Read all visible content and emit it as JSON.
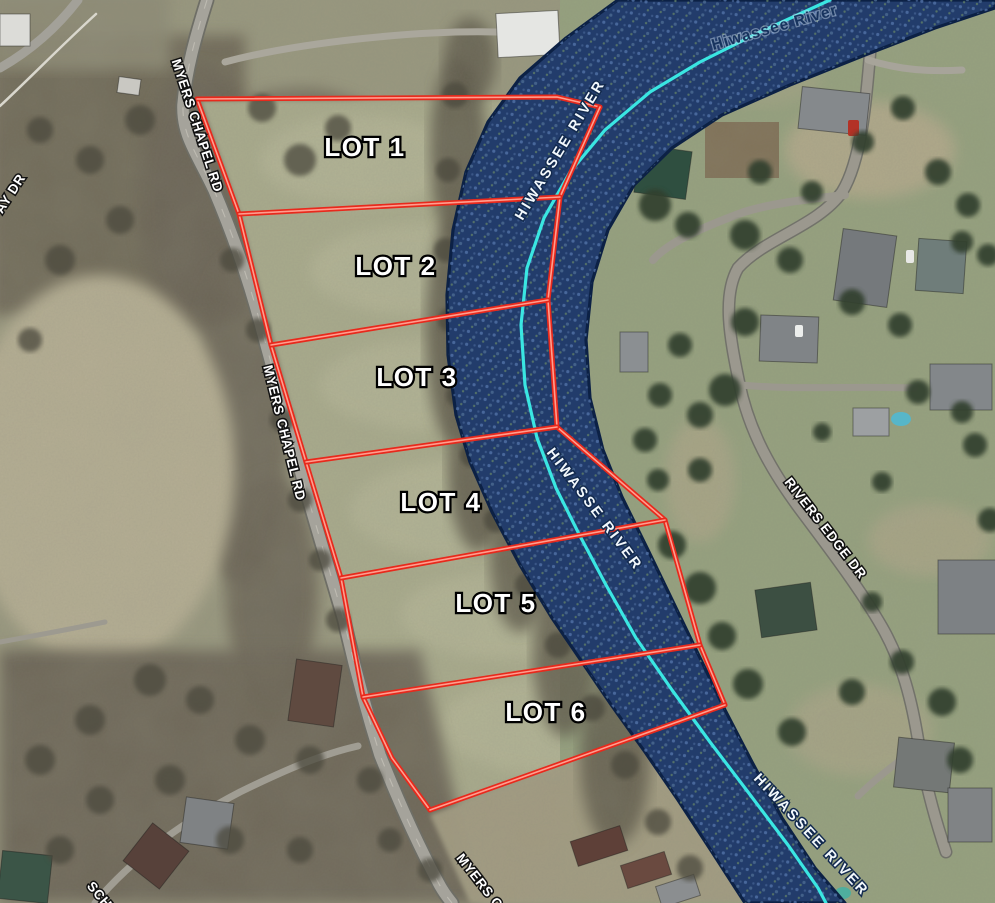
{
  "map": {
    "colors": {
      "land_base": "#98977e",
      "boundary_red": "#e8291c",
      "boundary_core": "#ff9e8f",
      "river_fill": "#223c6b",
      "river_edge": "#0c2145",
      "river_centerline": "#3ae6e2",
      "label_white": "#ffffff",
      "label_navy": "#17335e"
    },
    "lots": [
      {
        "name": "LOT 1",
        "x": 365,
        "y": 156
      },
      {
        "name": "LOT 2",
        "x": 396,
        "y": 275
      },
      {
        "name": "LOT 3",
        "x": 417,
        "y": 386
      },
      {
        "name": "LOT 4",
        "x": 441,
        "y": 511
      },
      {
        "name": "LOT 5",
        "x": 496,
        "y": 612
      },
      {
        "name": "LOT 6",
        "x": 546,
        "y": 721
      }
    ],
    "boundary_lines": [
      {
        "id": "plat-west-boundary",
        "d": "M197,99 L239,214 L271,345 L306,462 L341,578 L363,697 L392,758 L430,810"
      },
      {
        "id": "plat-north-boundary",
        "d": "M197,99 L557,97 L600,107"
      },
      {
        "id": "plat-east-boundary",
        "d": "M600,107 L560,197 L548,300 L557,427 L665,520 L700,645 L725,705"
      },
      {
        "id": "divider-lot1-lot2",
        "d": "M239,214 L560,197"
      },
      {
        "id": "divider-lot2-lot3",
        "d": "M271,345 L548,300"
      },
      {
        "id": "divider-lot3-lot4",
        "d": "M306,462 L557,427"
      },
      {
        "id": "divider-lot4-lot5",
        "d": "M341,578 L665,520"
      },
      {
        "id": "divider-lot5-lot6",
        "d": "M363,697 L700,645"
      },
      {
        "id": "plat-south-boundary",
        "d": "M430,810 L725,705"
      }
    ],
    "river": {
      "outline": "M618,0 L566,38 L520,78 L488,122 L466,172 L453,230 L447,295 L448,355 L456,415 L470,462 L492,512 L520,565 L552,618 L582,662 L612,706 L645,752 L678,800 L712,852 L745,903 L845,903 L815,868 L782,818 L752,762 L725,710 L702,662 L676,608 L648,550 L622,497 L603,450 L590,398 L586,340 L592,282 L608,230 L634,185 L672,148 L722,115 L790,85 L865,55 L935,28 L995,8 L995,0 Z",
      "centerline": "M830,0 L760,32 L700,62 L650,92 L605,130 L570,172 L544,218 L527,268 L521,325 L525,385 L537,438 L556,488 L580,536 L606,585 L636,638 L672,690 L710,742 L748,792 L788,845 L818,888 L826,903"
    },
    "labels": [
      {
        "id": "myers-chapel-rd-top",
        "text": "MYERS CHAPEL RD",
        "x": 193,
        "y": 127,
        "rot": 72,
        "style": "road"
      },
      {
        "id": "myers-chapel-rd-mid",
        "text": "MYERS CHAPEL RD",
        "x": 280,
        "y": 434,
        "rot": 76,
        "style": "road"
      },
      {
        "id": "myers-chapel-rd-bottom",
        "text": "MYERS C",
        "x": 476,
        "y": 884,
        "rot": 52,
        "style": "road"
      },
      {
        "id": "ay-dr-partial",
        "text": "AY DR",
        "x": 14,
        "y": 196,
        "rot": -57,
        "style": "road"
      },
      {
        "id": "sch-partial",
        "text": "SCH",
        "x": 96,
        "y": 898,
        "rot": 50,
        "style": "road"
      },
      {
        "id": "rivers-edge-dr",
        "text": "RIVERS EDGE DR",
        "x": 822,
        "y": 531,
        "rot": 52,
        "style": "road"
      },
      {
        "id": "hiwassee-river-top-right",
        "text": "Hiwassee River",
        "x": 776,
        "y": 32,
        "rot": -16,
        "style": "river-navy"
      },
      {
        "id": "hiwassee-river-upper",
        "text": "HIWASSEE RIVER",
        "x": 564,
        "y": 152,
        "rot": -59,
        "style": "river"
      },
      {
        "id": "hiwassee-river-middle",
        "text": "HIWASSE RIVER",
        "x": 591,
        "y": 512,
        "rot": 53,
        "style": "river"
      },
      {
        "id": "hiwassee-river-bottom",
        "text": "HIWASSEE RIVER",
        "x": 808,
        "y": 838,
        "rot": 47,
        "style": "river"
      }
    ],
    "patches": [
      {
        "t": "rect",
        "x": -10,
        "y": 35,
        "w": 255,
        "h": 280,
        "f": "#6e6757",
        "blur": 2,
        "o": 0.95
      },
      {
        "t": "rect",
        "x": -10,
        "y": -10,
        "w": 180,
        "h": 80,
        "f": "#8d8a74",
        "blur": 2,
        "o": 0.9
      },
      {
        "t": "ell",
        "cx": 200,
        "cy": 200,
        "rx": 62,
        "ry": 135,
        "f": "#6a6355",
        "blur": 2,
        "o": 0.9
      },
      {
        "t": "ell",
        "cx": 240,
        "cy": 420,
        "rx": 48,
        "ry": 165,
        "f": "#6a6355",
        "blur": 2,
        "o": 0.85
      },
      {
        "t": "ell",
        "cx": 272,
        "cy": 590,
        "rx": 46,
        "ry": 115,
        "f": "#6a6355",
        "blur": 2,
        "o": 0.85
      },
      {
        "t": "ell",
        "cx": 100,
        "cy": 470,
        "rx": 135,
        "ry": 195,
        "f": "#b5ae93",
        "blur": 2,
        "o": 1
      },
      {
        "t": "ell",
        "cx": 300,
        "cy": 150,
        "rx": 95,
        "ry": 62,
        "f": "#6e6858",
        "blur": 2,
        "o": 0.8
      },
      {
        "t": "path",
        "d": "M200,100 L560,100 L600,110 L555,300 L560,430 L665,525 L700,645 L725,705 L430,810 L360,695 L305,460 L240,215 Z",
        "f": "#a9ab8c",
        "blur": 1,
        "o": 1
      },
      {
        "t": "ell",
        "cx": 360,
        "cy": 160,
        "rx": 100,
        "ry": 45,
        "f": "#b7b899",
        "blur": 2,
        "o": 0.7
      },
      {
        "t": "ell",
        "cx": 420,
        "cy": 270,
        "rx": 110,
        "ry": 45,
        "f": "#b7b899",
        "blur": 2,
        "o": 0.7
      },
      {
        "t": "ell",
        "cx": 430,
        "cy": 385,
        "rx": 110,
        "ry": 45,
        "f": "#b7b899",
        "blur": 2,
        "o": 0.7
      },
      {
        "t": "ell",
        "cx": 470,
        "cy": 510,
        "rx": 120,
        "ry": 50,
        "f": "#b7b899",
        "blur": 2,
        "o": 0.7
      },
      {
        "t": "ell",
        "cx": 515,
        "cy": 615,
        "rx": 115,
        "ry": 45,
        "f": "#b7b899",
        "blur": 2,
        "o": 0.7
      },
      {
        "t": "ell",
        "cx": 560,
        "cy": 725,
        "rx": 120,
        "ry": 50,
        "f": "#b7b899",
        "blur": 2,
        "o": 0.7
      },
      {
        "t": "rect",
        "x": 560,
        "y": -10,
        "w": 445,
        "h": 923,
        "f": "#95a17e",
        "blur": 0,
        "o": 1
      },
      {
        "t": "path",
        "d": "M0,650 L420,650 L480,903 L0,903 Z",
        "f": "#6c6556",
        "blur": 2,
        "o": 0.95
      },
      {
        "t": "path",
        "d": "M430,815 L700,710 L760,800 L790,903 L470,903 Z",
        "f": "#a39c82",
        "blur": 1,
        "o": 0.95
      },
      {
        "t": "ell",
        "cx": 458,
        "cy": 150,
        "rx": 28,
        "ry": 92,
        "f": "#5d584a",
        "blur": 2,
        "o": 0.85
      },
      {
        "t": "ell",
        "cx": 452,
        "cy": 330,
        "rx": 26,
        "ry": 112,
        "f": "#5d584a",
        "blur": 2,
        "o": 0.85
      },
      {
        "t": "ell",
        "cx": 478,
        "cy": 470,
        "rx": 30,
        "ry": 82,
        "f": "#5d584a",
        "blur": 2,
        "o": 0.85
      },
      {
        "t": "ell",
        "cx": 520,
        "cy": 560,
        "rx": 30,
        "ry": 72,
        "f": "#5d584a",
        "blur": 2,
        "o": 0.8
      },
      {
        "t": "ell",
        "cx": 565,
        "cy": 655,
        "rx": 32,
        "ry": 82,
        "f": "#5d584a",
        "blur": 2,
        "o": 0.8
      },
      {
        "t": "ell",
        "cx": 615,
        "cy": 760,
        "rx": 35,
        "ry": 86,
        "f": "#5d584a",
        "blur": 2,
        "o": 0.8
      },
      {
        "t": "ell",
        "cx": 470,
        "cy": 60,
        "rx": 26,
        "ry": 42,
        "f": "#5d584a",
        "blur": 2,
        "o": 0.8
      },
      {
        "t": "ell",
        "cx": 870,
        "cy": 150,
        "rx": 85,
        "ry": 48,
        "f": "#b9ac8e",
        "blur": 2,
        "o": 0.75
      },
      {
        "t": "ell",
        "cx": 700,
        "cy": 480,
        "rx": 35,
        "ry": 62,
        "f": "#b3a88b",
        "blur": 2,
        "o": 0.6
      },
      {
        "t": "ell",
        "cx": 930,
        "cy": 540,
        "rx": 62,
        "ry": 36,
        "f": "#b3a88b",
        "blur": 2,
        "o": 0.6
      },
      {
        "t": "ell",
        "cx": 860,
        "cy": 730,
        "rx": 72,
        "ry": 46,
        "f": "#b3a88b",
        "blur": 2,
        "o": 0.55
      },
      {
        "t": "ell",
        "cx": 760,
        "cy": 80,
        "rx": 60,
        "ry": 26,
        "f": "#a8a586",
        "blur": 2,
        "o": 0.5
      },
      {
        "t": "rect",
        "x": 705,
        "y": 122,
        "w": 74,
        "h": 56,
        "f": "#7e6f55",
        "blur": 0,
        "o": 0.95
      }
    ],
    "roads": [
      {
        "id": "myers-chapel-rd",
        "d": "M207,0 C196,35 186,70 183,105 C182,135 196,152 214,190 C233,235 249,280 262,330 C276,380 289,430 303,480 C317,530 331,575 344,620 C354,665 366,710 380,755 C398,800 418,845 438,882 C443,892 448,898 452,903",
        "w": 11.5,
        "c": "#a5a39b",
        "casing": "#6e6e66",
        "cw": 15,
        "center": true
      },
      {
        "id": "rivers-edge-dr",
        "d": "M875,0 C868,55 868,150 842,192 C818,226 765,238 738,268 C722,296 730,338 739,382 C749,432 772,472 802,512 C832,552 862,592 882,627 C902,662 912,700 919,746 C926,788 936,822 946,852",
        "w": 10,
        "c": "#9b988e",
        "casing": "#72726a",
        "cw": 13,
        "center": false
      },
      {
        "id": "rivers-edge-spur-west",
        "d": "M845,195 C800,200 770,204 744,212 C706,226 668,242 653,260",
        "w": 8,
        "c": "#9b988e"
      },
      {
        "id": "rivers-edge-spur-pool",
        "d": "M742,385 C790,390 850,386 915,388",
        "w": 7,
        "c": "#9b988e"
      },
      {
        "id": "rivers-edge-spur-bottom",
        "d": "M919,746 C898,762 876,778 858,796",
        "w": 7,
        "c": "#9b988e"
      },
      {
        "id": "top-right-drive",
        "d": "M868,60 C900,70 930,72 962,70",
        "w": 7,
        "c": "#a7a49a"
      },
      {
        "id": "barn-driveway",
        "d": "M225,62 C300,42 420,30 497,32",
        "w": 7,
        "c": "#aaa79c"
      },
      {
        "id": "top-left-road",
        "d": "M78,0 C55,30 28,52 0,68",
        "w": 9,
        "c": "#a3a199"
      },
      {
        "id": "top-left-fence",
        "d": "M0,106 C30,78 62,45 96,14",
        "w": 2.5,
        "c": "#d9d7cd"
      },
      {
        "id": "bottom-left-drive",
        "d": "M95,903 C135,855 190,818 240,792 C285,770 322,754 358,746",
        "w": 7,
        "c": "#a09d93"
      },
      {
        "id": "bottom-left-lane",
        "d": "M0,642 C45,634 80,627 105,622",
        "w": 5,
        "c": "#9d9a90"
      }
    ],
    "houses": [
      [
        497,
        12,
        62,
        44,
        -3,
        "#e5e6e3"
      ],
      [
        0,
        14,
        30,
        32,
        0,
        "#dcdcd8"
      ],
      [
        118,
        78,
        22,
        16,
        8,
        "#c9c8c2"
      ],
      [
        637,
        148,
        52,
        48,
        8,
        "#2f4f40"
      ],
      [
        800,
        90,
        68,
        42,
        6,
        "#85898c"
      ],
      [
        838,
        232,
        54,
        72,
        8,
        "#75797c"
      ],
      [
        917,
        240,
        48,
        52,
        4,
        "#6f7d7a"
      ],
      [
        760,
        316,
        58,
        46,
        2,
        "#808487"
      ],
      [
        620,
        332,
        28,
        40,
        0,
        "#8b8f92"
      ],
      [
        930,
        364,
        62,
        46,
        0,
        "#83878a"
      ],
      [
        853,
        408,
        36,
        28,
        0,
        "#9da0a2"
      ],
      [
        938,
        560,
        58,
        74,
        0,
        "#7d8184"
      ],
      [
        758,
        586,
        56,
        48,
        -8,
        "#3c4f42"
      ],
      [
        896,
        740,
        56,
        50,
        6,
        "#747876"
      ],
      [
        948,
        788,
        44,
        54,
        0,
        "#808385"
      ],
      [
        292,
        662,
        46,
        62,
        8,
        "#5f4a40"
      ],
      [
        133,
        832,
        46,
        48,
        38,
        "#57413a"
      ],
      [
        183,
        800,
        48,
        46,
        8,
        "#7f8284"
      ],
      [
        0,
        853,
        50,
        48,
        6,
        "#3b5547"
      ],
      [
        573,
        833,
        52,
        26,
        -18,
        "#5e4038"
      ],
      [
        623,
        858,
        46,
        24,
        -18,
        "#6a4a40"
      ],
      [
        658,
        880,
        40,
        22,
        -18,
        "#8b8e90"
      ]
    ],
    "cars": [
      [
        848,
        120,
        11,
        16,
        "#b33226"
      ],
      [
        906,
        250,
        8,
        13,
        "#e8e8e6"
      ],
      [
        795,
        325,
        8,
        12,
        "#eceeec"
      ],
      [
        851,
        27,
        14,
        9,
        "#f0f0ee"
      ],
      [
        872,
        30,
        13,
        8,
        "#3a3d40"
      ]
    ],
    "pools": [
      {
        "cx": 901,
        "cy": 419,
        "rx": 10,
        "ry": 7,
        "f": "#57b6c9"
      },
      {
        "cx": 843,
        "cy": 893,
        "rx": 8,
        "ry": 6,
        "f": "#4fae9e"
      }
    ],
    "trees_dark": [
      [
        655,
        205,
        16
      ],
      [
        688,
        225,
        13
      ],
      [
        745,
        235,
        15
      ],
      [
        790,
        260,
        13
      ],
      [
        745,
        322,
        14
      ],
      [
        725,
        390,
        16
      ],
      [
        680,
        345,
        12
      ],
      [
        660,
        395,
        12
      ],
      [
        700,
        415,
        13
      ],
      [
        852,
        302,
        13
      ],
      [
        900,
        325,
        12
      ],
      [
        938,
        172,
        13
      ],
      [
        968,
        205,
        12
      ],
      [
        988,
        255,
        11
      ],
      [
        918,
        392,
        12
      ],
      [
        962,
        412,
        11
      ],
      [
        863,
        142,
        11
      ],
      [
        903,
        108,
        12
      ],
      [
        760,
        172,
        12
      ],
      [
        812,
        192,
        11
      ],
      [
        672,
        545,
        14
      ],
      [
        700,
        588,
        16
      ],
      [
        722,
        636,
        14
      ],
      [
        748,
        684,
        15
      ],
      [
        792,
        732,
        14
      ],
      [
        852,
        692,
        13
      ],
      [
        902,
        662,
        12
      ],
      [
        942,
        702,
        14
      ],
      [
        872,
        602,
        10
      ],
      [
        960,
        760,
        13
      ],
      [
        990,
        520,
        12
      ],
      [
        975,
        445,
        12
      ],
      [
        882,
        482,
        10
      ],
      [
        822,
        432,
        9
      ],
      [
        962,
        242,
        11
      ],
      [
        700,
        470,
        12
      ],
      [
        645,
        440,
        12
      ],
      [
        658,
        480,
        11
      ]
    ],
    "trees_grey": [
      [
        262,
        108,
        14
      ],
      [
        300,
        160,
        16
      ],
      [
        338,
        128,
        13
      ],
      [
        232,
        260,
        12
      ],
      [
        258,
        330,
        12
      ],
      [
        282,
        420,
        12
      ],
      [
        300,
        500,
        12
      ],
      [
        320,
        560,
        11
      ],
      [
        338,
        620,
        12
      ],
      [
        140,
        120,
        15
      ],
      [
        90,
        160,
        14
      ],
      [
        40,
        130,
        13
      ],
      [
        120,
        220,
        14
      ],
      [
        60,
        260,
        15
      ],
      [
        30,
        340,
        12
      ],
      [
        150,
        680,
        16
      ],
      [
        90,
        720,
        15
      ],
      [
        200,
        700,
        14
      ],
      [
        250,
        740,
        15
      ],
      [
        310,
        760,
        14
      ],
      [
        370,
        780,
        13
      ],
      [
        170,
        780,
        15
      ],
      [
        100,
        800,
        14
      ],
      [
        40,
        760,
        15
      ],
      [
        230,
        840,
        14
      ],
      [
        300,
        850,
        13
      ],
      [
        60,
        850,
        14
      ],
      [
        390,
        840,
        12
      ],
      [
        430,
        870,
        12
      ],
      [
        455,
        95,
        13
      ],
      [
        448,
        170,
        12
      ],
      [
        446,
        250,
        12
      ],
      [
        450,
        320,
        12
      ],
      [
        458,
        395,
        12
      ],
      [
        472,
        455,
        12
      ],
      [
        496,
        520,
        12
      ],
      [
        528,
        585,
        13
      ],
      [
        558,
        645,
        13
      ],
      [
        592,
        708,
        13
      ],
      [
        625,
        765,
        14
      ],
      [
        658,
        822,
        13
      ],
      [
        690,
        868,
        13
      ]
    ]
  }
}
